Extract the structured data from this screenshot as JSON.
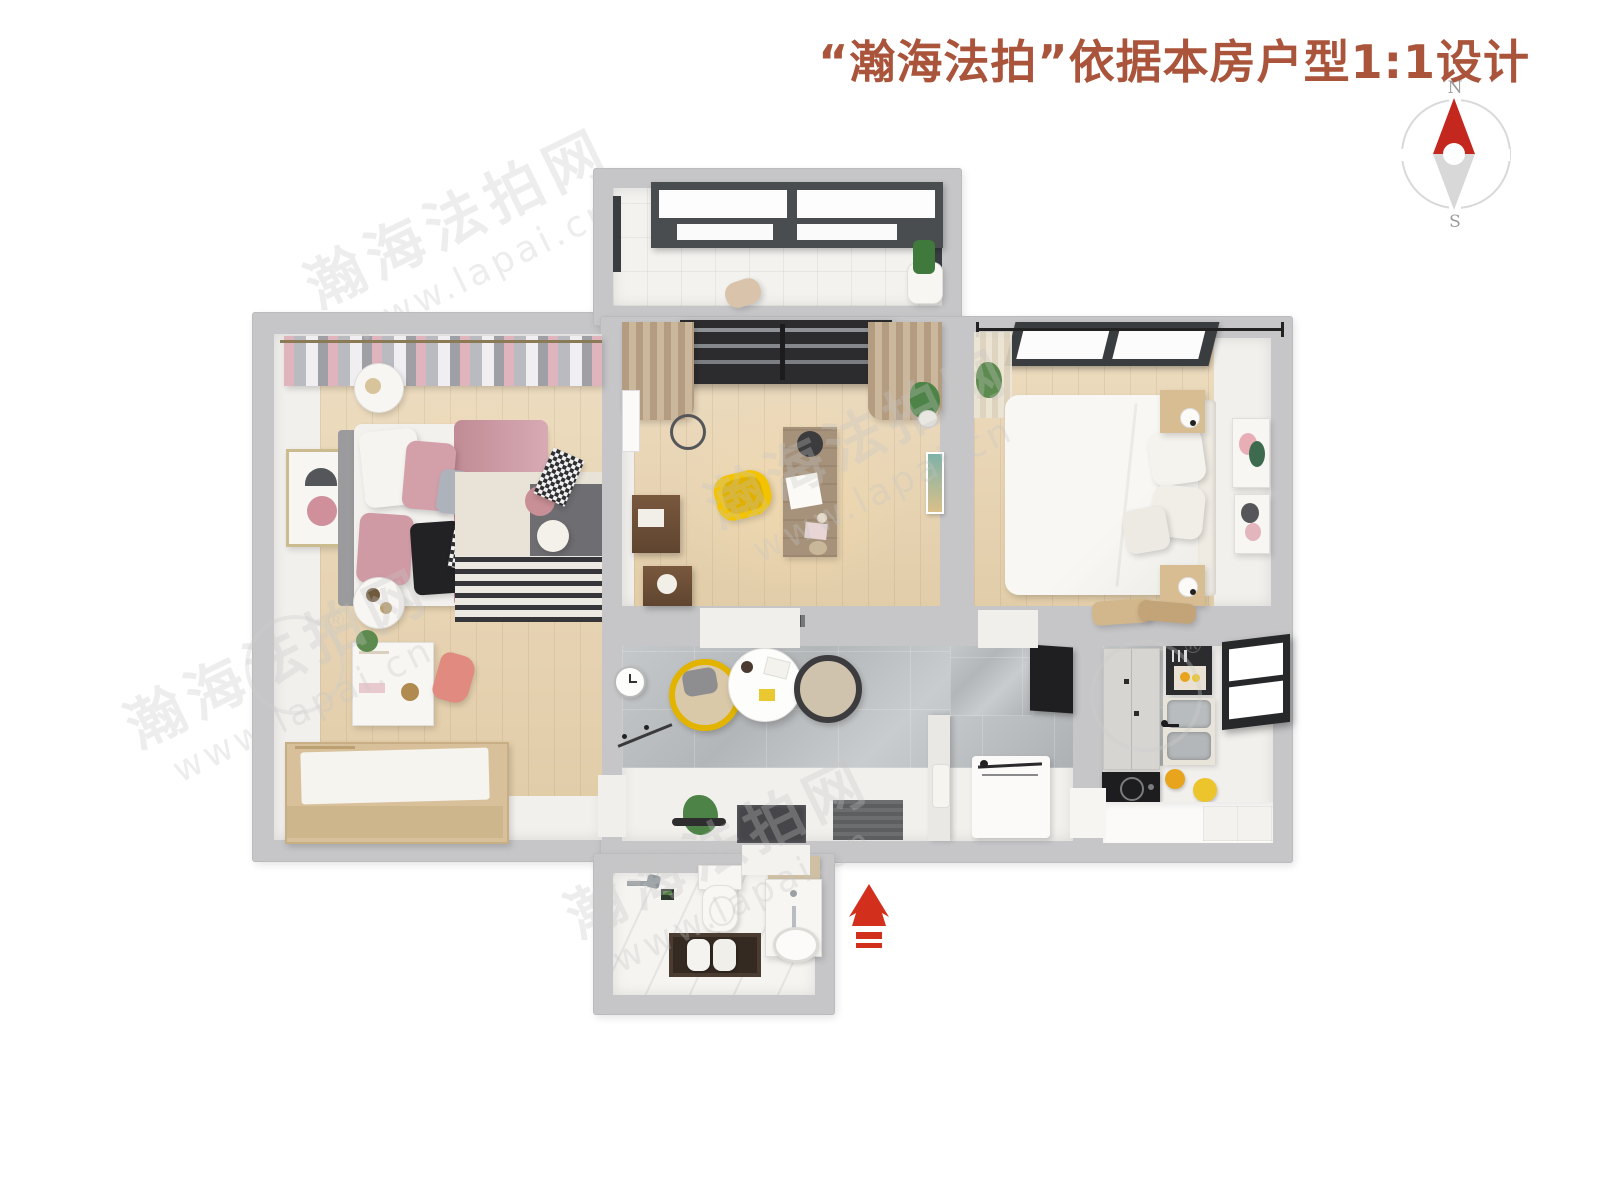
{
  "header": {
    "title": "“瀚海法拍”依据本房户型1:1设计",
    "title_color": "#a9543b"
  },
  "compass": {
    "icon": "compass-icon",
    "north_label": "N",
    "south_label": "S",
    "needle_north_color": "#c4271d",
    "needle_south_color": "#d8d8d8",
    "ring_color": "#d9d9d9"
  },
  "watermark": {
    "brand": "瀚海法拍网",
    "url": "www.lapai.cn",
    "registered_mark": "®"
  },
  "entrance_arrow": {
    "icon": "entrance-arrow-icon",
    "color": "#d2301c",
    "direction": "up"
  },
  "palette": {
    "outer_wall": "#c6c6c8",
    "inner_wall": "#f2f0ed",
    "wood_floor": "#e6d6ba",
    "gray_tile": "#b8bbbd",
    "white_tile": "#f3f2ef",
    "accent_yellow": "#f2c300",
    "bed_pink": "#cf9aa4",
    "dark_wood": "#6e4f37"
  }
}
